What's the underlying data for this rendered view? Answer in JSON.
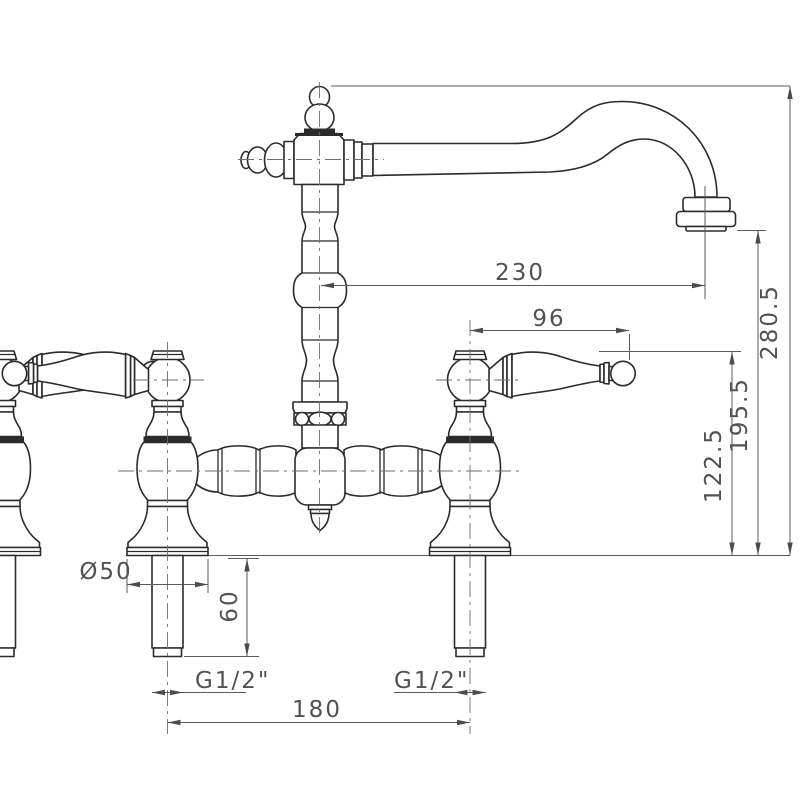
{
  "drawing": {
    "background": "#ffffff",
    "line_color": "#2b2b2b",
    "dimension_color": "#5a5a5a",
    "dimensions": {
      "spout_reach": "230",
      "overall_height": "280.5",
      "handle_length": "96",
      "outlet_height": "195.5",
      "handle_height": "122.5",
      "base_diameter": "Ø50",
      "shank_length": "60",
      "inlet_thread_left": "G1/2\"",
      "inlet_thread_right": "G1/2\"",
      "hole_centres": "180"
    }
  }
}
